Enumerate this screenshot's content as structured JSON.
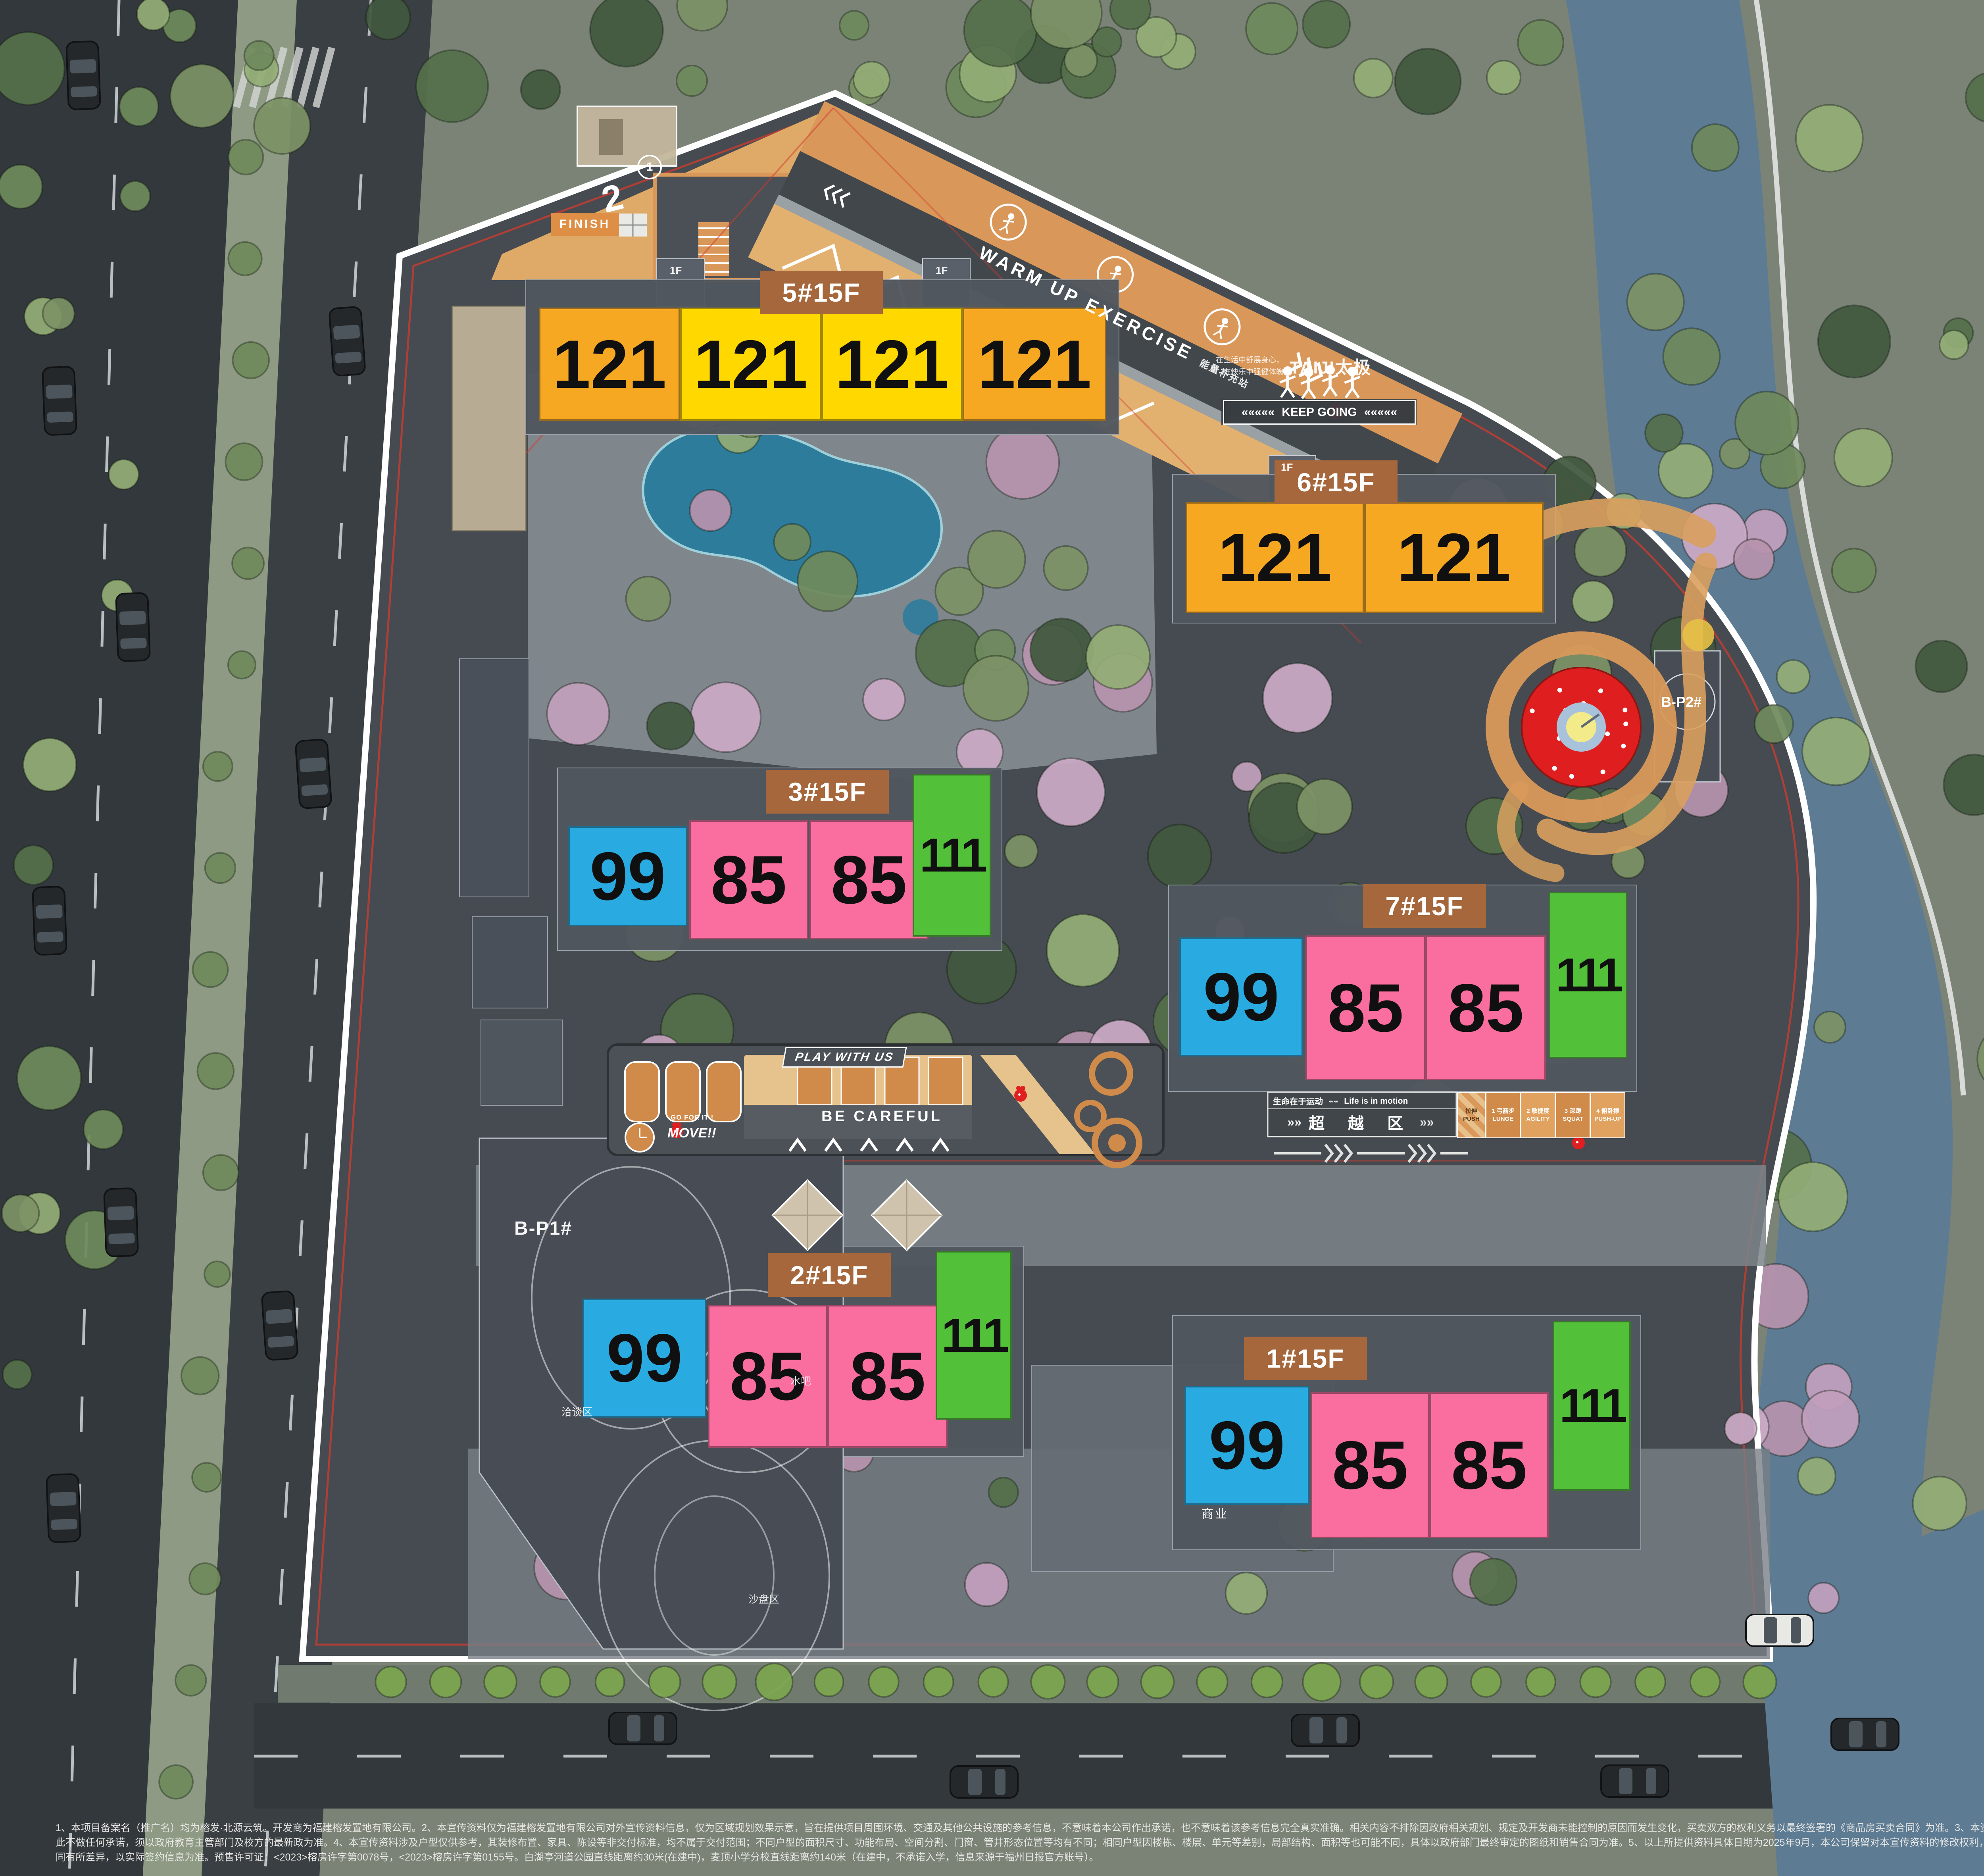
{
  "colors": {
    "orange": "#F7A823",
    "yellow": "#FFD800",
    "blue": "#29ABE2",
    "pink": "#F96E9E",
    "green": "#53C03A",
    "label_bg": "#A5673B",
    "label_text": "#FFFFFF",
    "number_text": "#101010",
    "river": "#5D7B93",
    "site_bg": "#454B50",
    "track_orange": "#D9985A",
    "playground_red": "#DF1F1F"
  },
  "buildings": [
    {
      "label": "5#15F",
      "units": [
        {
          "area": "121",
          "color": "orange"
        },
        {
          "area": "121",
          "color": "yellow"
        },
        {
          "area": "121",
          "color": "yellow"
        },
        {
          "area": "121",
          "color": "orange"
        }
      ]
    },
    {
      "label": "6#15F",
      "units": [
        {
          "area": "121",
          "color": "orange"
        },
        {
          "area": "121",
          "color": "orange"
        }
      ]
    },
    {
      "label": "3#15F",
      "units": [
        {
          "area": "99",
          "color": "blue"
        },
        {
          "area": "85",
          "color": "pink"
        },
        {
          "area": "85",
          "color": "pink"
        },
        {
          "area": "111",
          "color": "green"
        }
      ]
    },
    {
      "label": "7#15F",
      "units": [
        {
          "area": "99",
          "color": "blue"
        },
        {
          "area": "85",
          "color": "pink"
        },
        {
          "area": "85",
          "color": "pink"
        },
        {
          "area": "111",
          "color": "green"
        }
      ]
    },
    {
      "label": "2#15F",
      "units": [
        {
          "area": "99",
          "color": "blue"
        },
        {
          "area": "85",
          "color": "pink"
        },
        {
          "area": "85",
          "color": "pink"
        },
        {
          "area": "111",
          "color": "green"
        }
      ]
    },
    {
      "label": "1#15F",
      "units": [
        {
          "area": "99",
          "color": "blue"
        },
        {
          "area": "85",
          "color": "pink"
        },
        {
          "area": "85",
          "color": "pink"
        },
        {
          "area": "111",
          "color": "green"
        }
      ]
    }
  ],
  "track": {
    "finish": "FINISH",
    "keep_going": "KEEP GOING",
    "keep_chevrons": "«««««",
    "warm_up": "WARM UP EXERCISE",
    "energy_station": "能量补充站",
    "taiji": "TAIJI太极",
    "taiji_line1": "在生活中舒展身心，",
    "taiji_line2": "在快乐中强健体魄",
    "motto_cn": "生命在于运动",
    "motto_en": "Life is in motion",
    "zone_label": "超 越 区",
    "zone_chevrons": "»»",
    "course_marker_1": "1",
    "course_marker_2": "2",
    "stations": {
      "push": "拉伸\nPUSH",
      "s1": "1 弓箭步\nLUNGE",
      "s2": "2 敏捷度\nAGILITY",
      "s3": "3 深蹲\nSQUAT",
      "s4": "4 俯卧撑\nPUSH-UP"
    }
  },
  "play_area": {
    "play_with_us": "PLAY WITH US",
    "be_careful": "BE CAREFUL",
    "move": "MOVE!!",
    "go_for_it": "GO FOR IT !"
  },
  "facilities": {
    "b_p1": "B-P1#",
    "b_p2": "B-P2#",
    "negotiation_area": "洽谈区",
    "water_bar": "水吧",
    "sand_table_area": "沙盘区",
    "commercial": "商业",
    "floor_tag": "1F"
  },
  "disclaimer": {
    "line1": "1、本项目备案名（推广名）均为榕发·北源云筑。开发商为福建榕发置地有限公司。2、本宣传资料仅为福建榕发置地有限公司对外宣传资料信息，仅为区域规划效果示意，旨在提供项目周围环境、交通及其他公共设施的参考信息，不意味着本公司作出承诺，也不意味着该参考信息完全真实准确。相关内容不排除因政府相关规划、规定及开发商未能控制的原因而发生变化，买卖双方的权利义务以最终签署的《商品房买卖合同》为准。3、本资料所提及学校的名称、建成时间、开办学性质、办学规模、学校设置、开学时间、招生条件、收费标准及招生区域规划等均存在未确定性或调整的可能，本公司对",
    "line2": "此不做任何承诺，须以政府教育主管部门及校方的最新政为准。4、本宣传资料涉及户型仅供参考，其装修布置、家具、陈设等非交付标准，均不属于交付范围；不同户型的面积尺寸、功能布局、空间分割、门窗、管井形态位置等均有不同；相同户型因楼栋、楼层、单元等差别，局部结构、面积等也可能不同，具体以政府部门最终审定的图纸和销售合同为准。5、以上所提供资料具体日期为2025年9月，本公司保留对本宣传资料的修改权利，如有调整恕不另行通知，敬请留意最新资料。本宣传资料中涉及价格仅针对指定房源，具体价格、折扣、优惠等信息，因销售时间、户型楼栋、楼层、方位等不",
    "line3": "同有所差异，以实际签约信息为准。预售许可证：<2023>榕房许字第0078号，<2023>榕房许字第0155号。白湖亭河道公园直线距离约30米(在建中)，麦顶小学分校直线距离约140米（在建中，不承诺入学，信息来源于福州日报官方账号）。"
  }
}
